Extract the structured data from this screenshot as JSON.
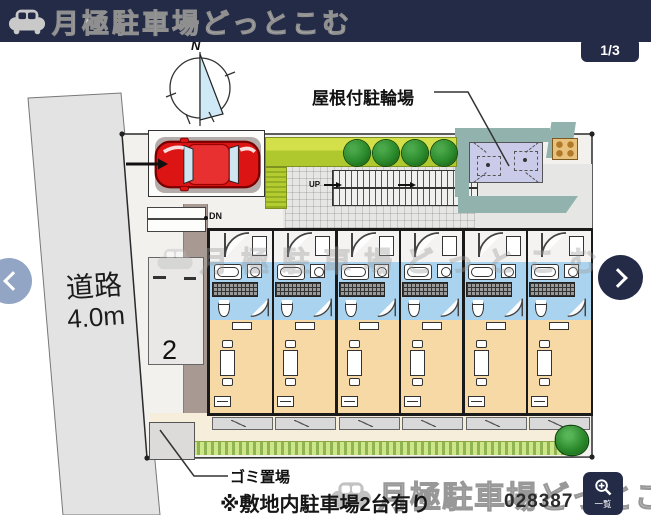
{
  "header": {
    "logo_text": "月極駐車場どっとこむ"
  },
  "viewer": {
    "page_indicator": "1/3",
    "zoom_tool_label": "一覧",
    "plan_id": "028387"
  },
  "plan": {
    "compass_north": "N",
    "bike_parking_label": "屋根付駐輪場",
    "road_label_line1": "道路",
    "road_label_line2": "4.0m",
    "parking_space_number": "2",
    "stairs_down_label": "DN",
    "stairs_up_label": "UP",
    "garbage_label": "ゴミ置場",
    "note": "※敷地内駐車場2台有り"
  },
  "watermark": {
    "logo_text": "月極駐車場どっとこむ"
  },
  "building": {
    "unit_count": 6
  },
  "colors": {
    "header_navy": "#232b47",
    "nav_prev_gray_blue": "#93a5c4",
    "car_red": "#dd1414",
    "unit_wet_blue": "#a9d3ef",
    "unit_living_tan": "#f6d9a4",
    "bike_lavender": "#c9cbe8",
    "shadow_teal": "#92b3ad",
    "grass_green": "#cde788",
    "tree_green": "#2b8a2b",
    "road_gray": "#e4e3e4"
  }
}
